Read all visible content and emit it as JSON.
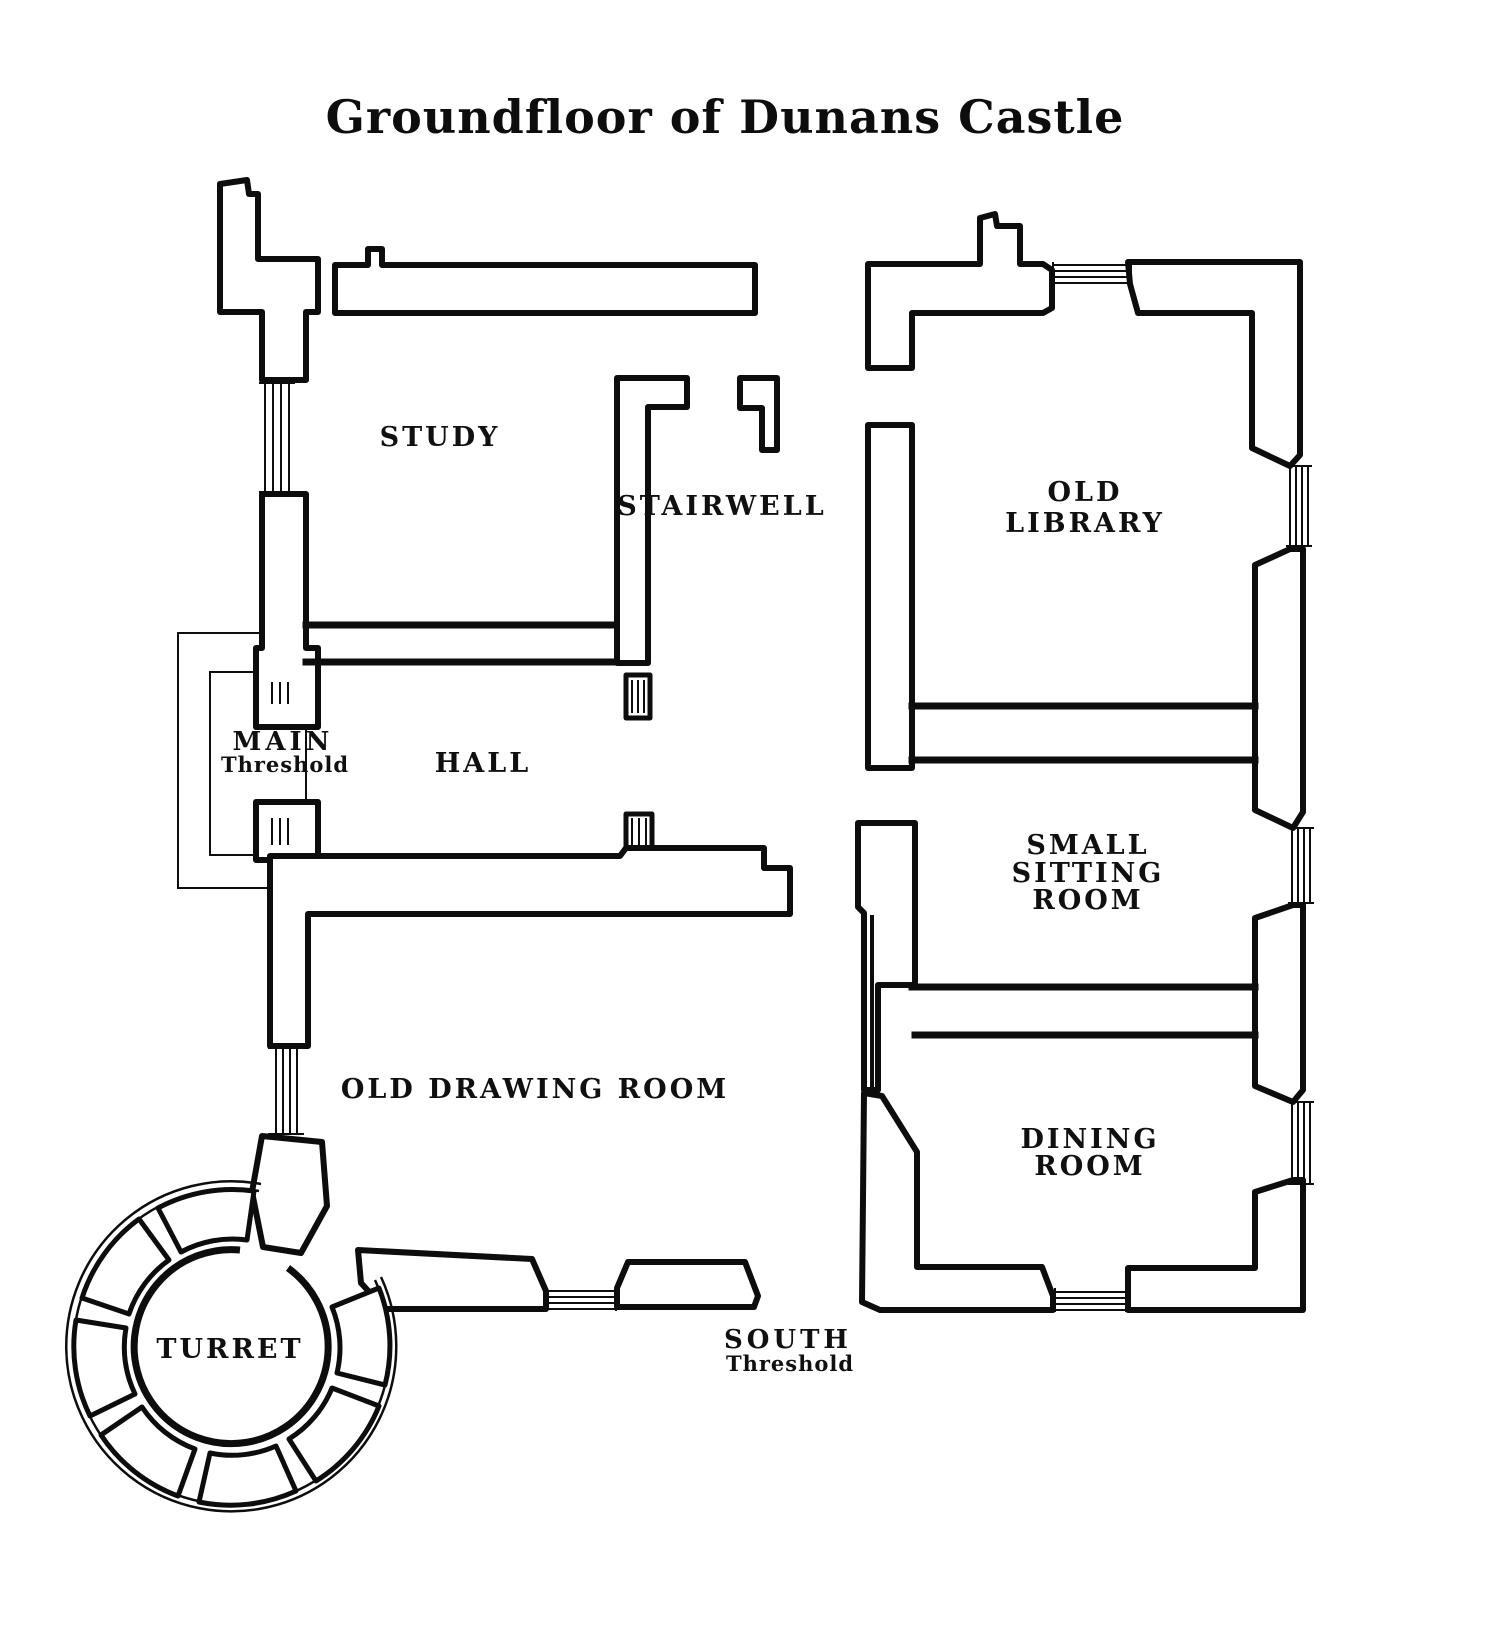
{
  "title": "Groundfloor of Dunans Castle",
  "colors": {
    "ink": "#0d0d0d",
    "background": "#ffffff"
  },
  "rooms": {
    "study": {
      "label": "STUDY"
    },
    "stairwell": {
      "label": "STAIRWELL"
    },
    "old_library": {
      "line1": "OLD",
      "line2": "LIBRARY"
    },
    "hall": {
      "label": "HALL"
    },
    "main_threshold": {
      "line1": "MAIN",
      "line2": "Threshold"
    },
    "small_sitting_room": {
      "line1": "SMALL",
      "line2": "SITTING",
      "line3": "ROOM"
    },
    "old_drawing_room": {
      "label": "OLD DRAWING ROOM"
    },
    "dining_room": {
      "line1": "DINING",
      "line2": "ROOM"
    },
    "turret": {
      "label": "TURRET"
    },
    "south_threshold": {
      "line1": "SOUTH",
      "line2": "Threshold"
    }
  }
}
